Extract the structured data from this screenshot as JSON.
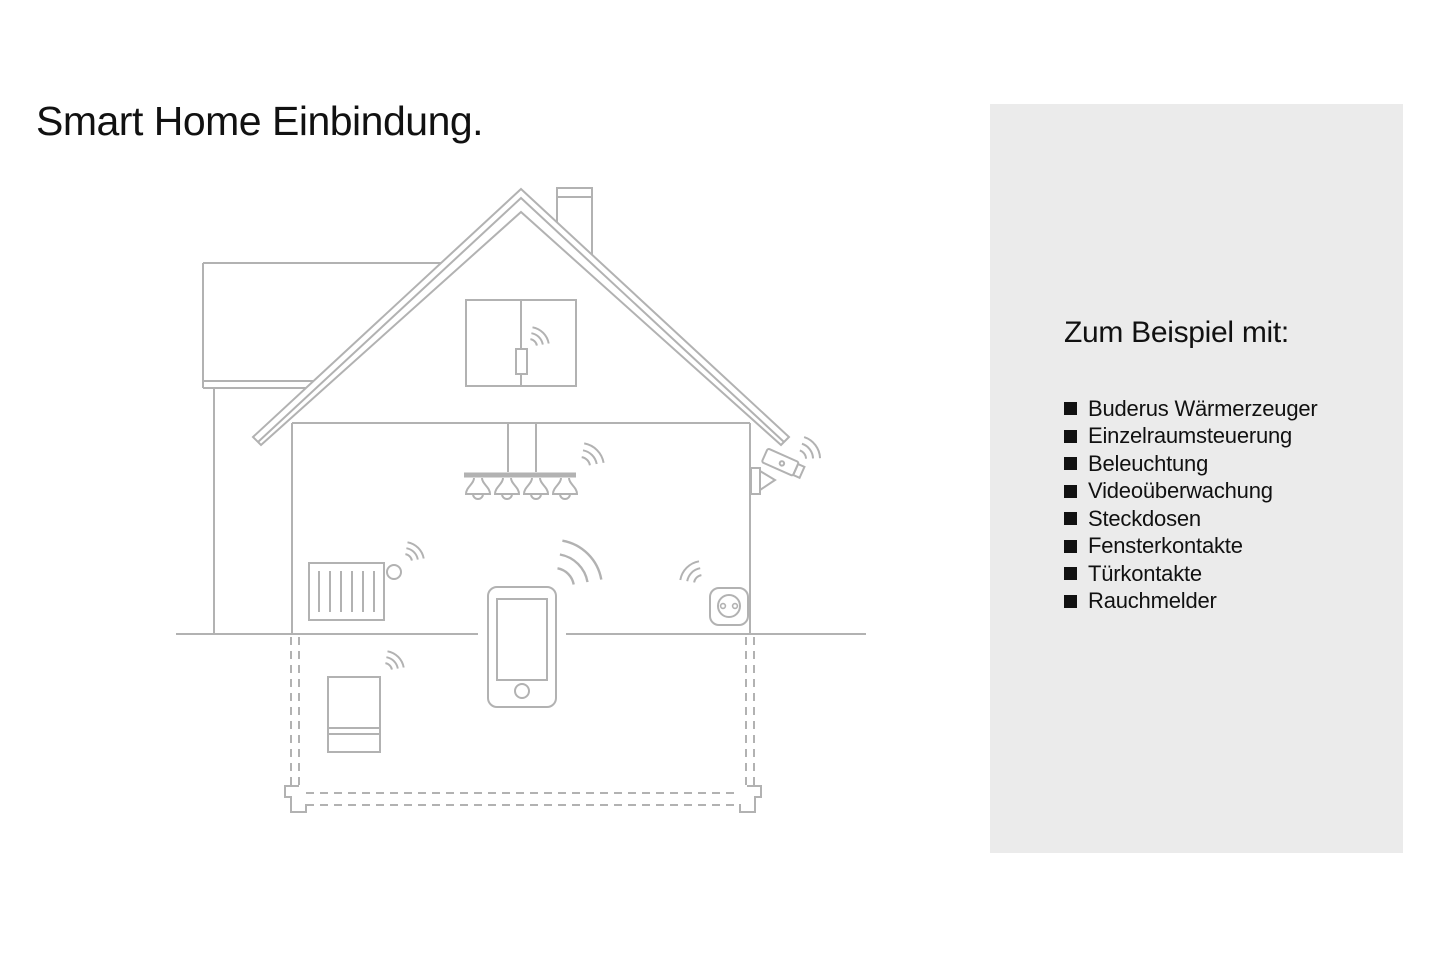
{
  "title": "Smart Home Einbindung.",
  "panel": {
    "heading": "Zum Beispiel mit:",
    "items": [
      "Buderus Wärmerzeuger",
      "Einzelraumsteuerung",
      "Beleuchtung",
      "Videoüberwachung",
      "Steckdosen",
      "Fensterkontakte",
      "Türkontakte",
      "Rauchmelder"
    ]
  },
  "illustration": {
    "icons": [
      "house-outline-icon",
      "chimney-icon",
      "attic-window-contact-icon",
      "ceiling-lights-icon",
      "security-camera-icon",
      "radiator-thermostat-icon",
      "power-socket-icon",
      "smartphone-icon",
      "boiler-icon",
      "basement-foundation-icon",
      "wifi-signal-icon"
    ],
    "colors": {
      "line": "#b2b2b2",
      "panel_bg": "#ebebeb",
      "text": "#111111",
      "bullet": "#111111"
    }
  }
}
